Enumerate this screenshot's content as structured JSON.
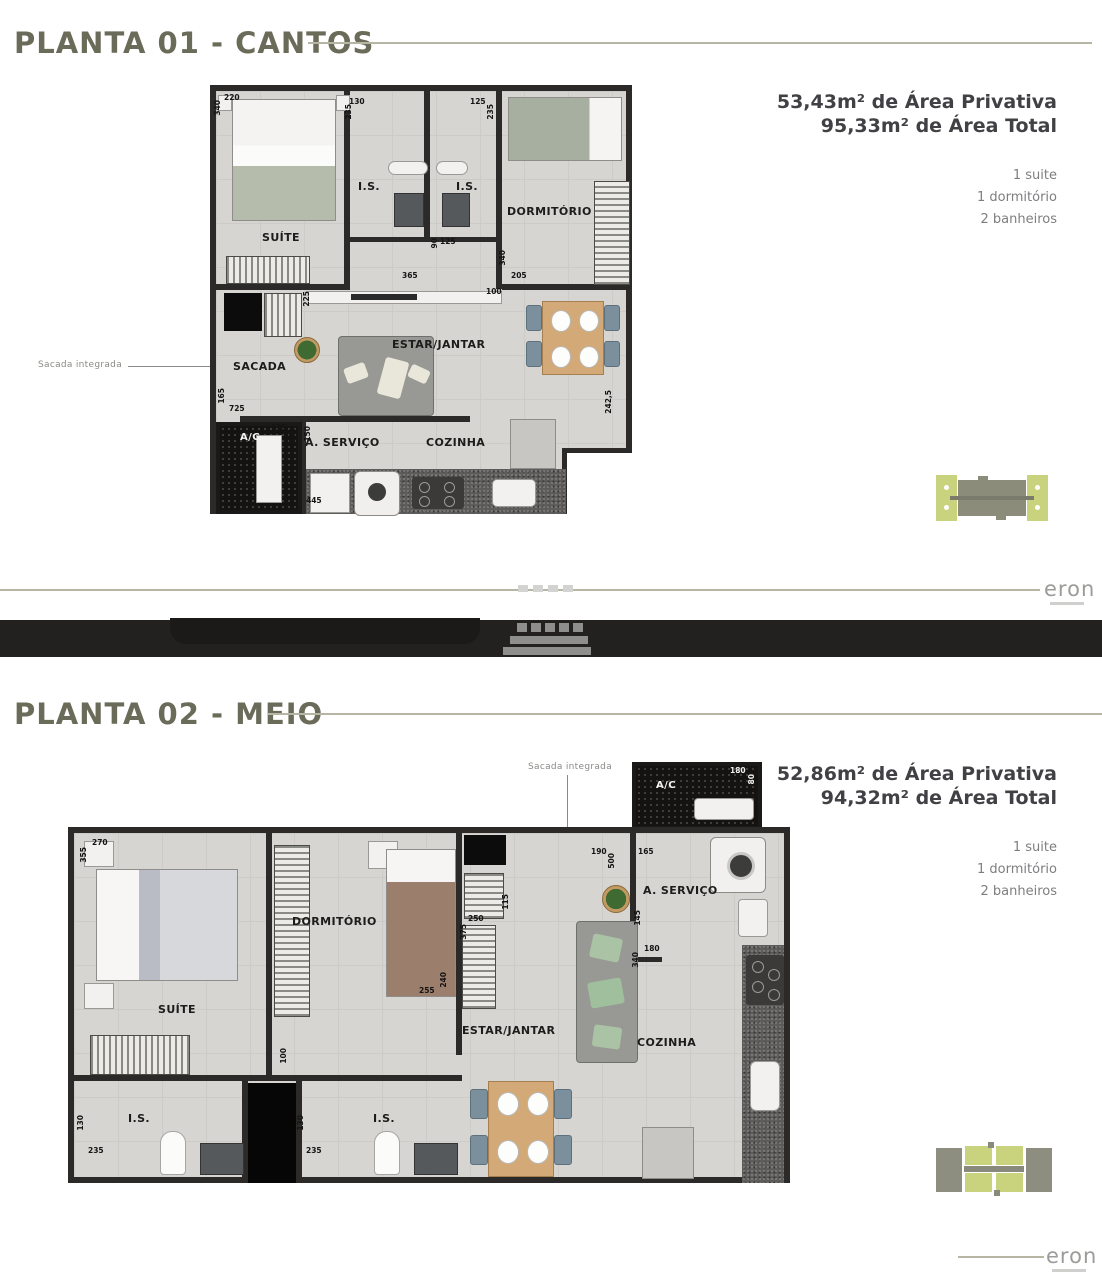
{
  "page1": {
    "title": "PLANTA 01 - CANTOS",
    "area_privativa": "53,43m² de Área Privativa",
    "area_total": "95,33m² de Área Total",
    "features": [
      "1 suite",
      "1 dormitório",
      "2 banheiros"
    ],
    "note": "Sacada integrada",
    "rooms": {
      "suite": "SUÍTE",
      "is1": "I.S.",
      "is2": "I.S.",
      "dormitorio": "DORMITÓRIO",
      "estar": "ESTAR/JANTAR",
      "sacada": "SACADA",
      "ac": "A/C",
      "servico": "A.  SERVIÇO",
      "cozinha": "COZINHA"
    },
    "dims": {
      "d1": "220",
      "d2": "340",
      "d3": "130",
      "d4": "235",
      "d5": "125",
      "d6": "235",
      "d7": "90",
      "d8": "125",
      "d9": "365",
      "d10": "340",
      "d11": "205",
      "d12": "100",
      "d13": "225",
      "d14": "165",
      "d15": "725",
      "d16": "135",
      "d17": "155",
      "d18": "150",
      "d19": "445",
      "d20": "242,5"
    }
  },
  "divider": {
    "brand": "eron"
  },
  "page2": {
    "title": "PLANTA 02 - MEIO",
    "area_privativa": "52,86m² de Área Privativa",
    "area_total": "94,32m² de Área Total",
    "features": [
      "1 suite",
      "1 dormitório",
      "2 banheiros"
    ],
    "note": "Sacada integrada",
    "rooms": {
      "suite": "SUÍTE",
      "dormitorio": "DORMITÓRIO",
      "estar": "ESTAR/JANTAR",
      "servico": "A.  SERVIÇO",
      "cozinha": "COZINHA",
      "ac": "A/C",
      "is1": "I.S.",
      "is2": "I.S."
    },
    "dims": {
      "d1": "270",
      "d2": "355",
      "d3": "190",
      "d4": "500",
      "d5": "165",
      "d6": "180",
      "d7": "80",
      "d8": "145",
      "d9": "180",
      "d10": "340",
      "d11": "115",
      "d12": "250",
      "d13": "375",
      "d14": "255",
      "d15": "240",
      "d16": "100",
      "d17": "130",
      "d18": "235",
      "d19": "130",
      "d20": "235"
    }
  },
  "footer": {
    "brand": "eron"
  }
}
